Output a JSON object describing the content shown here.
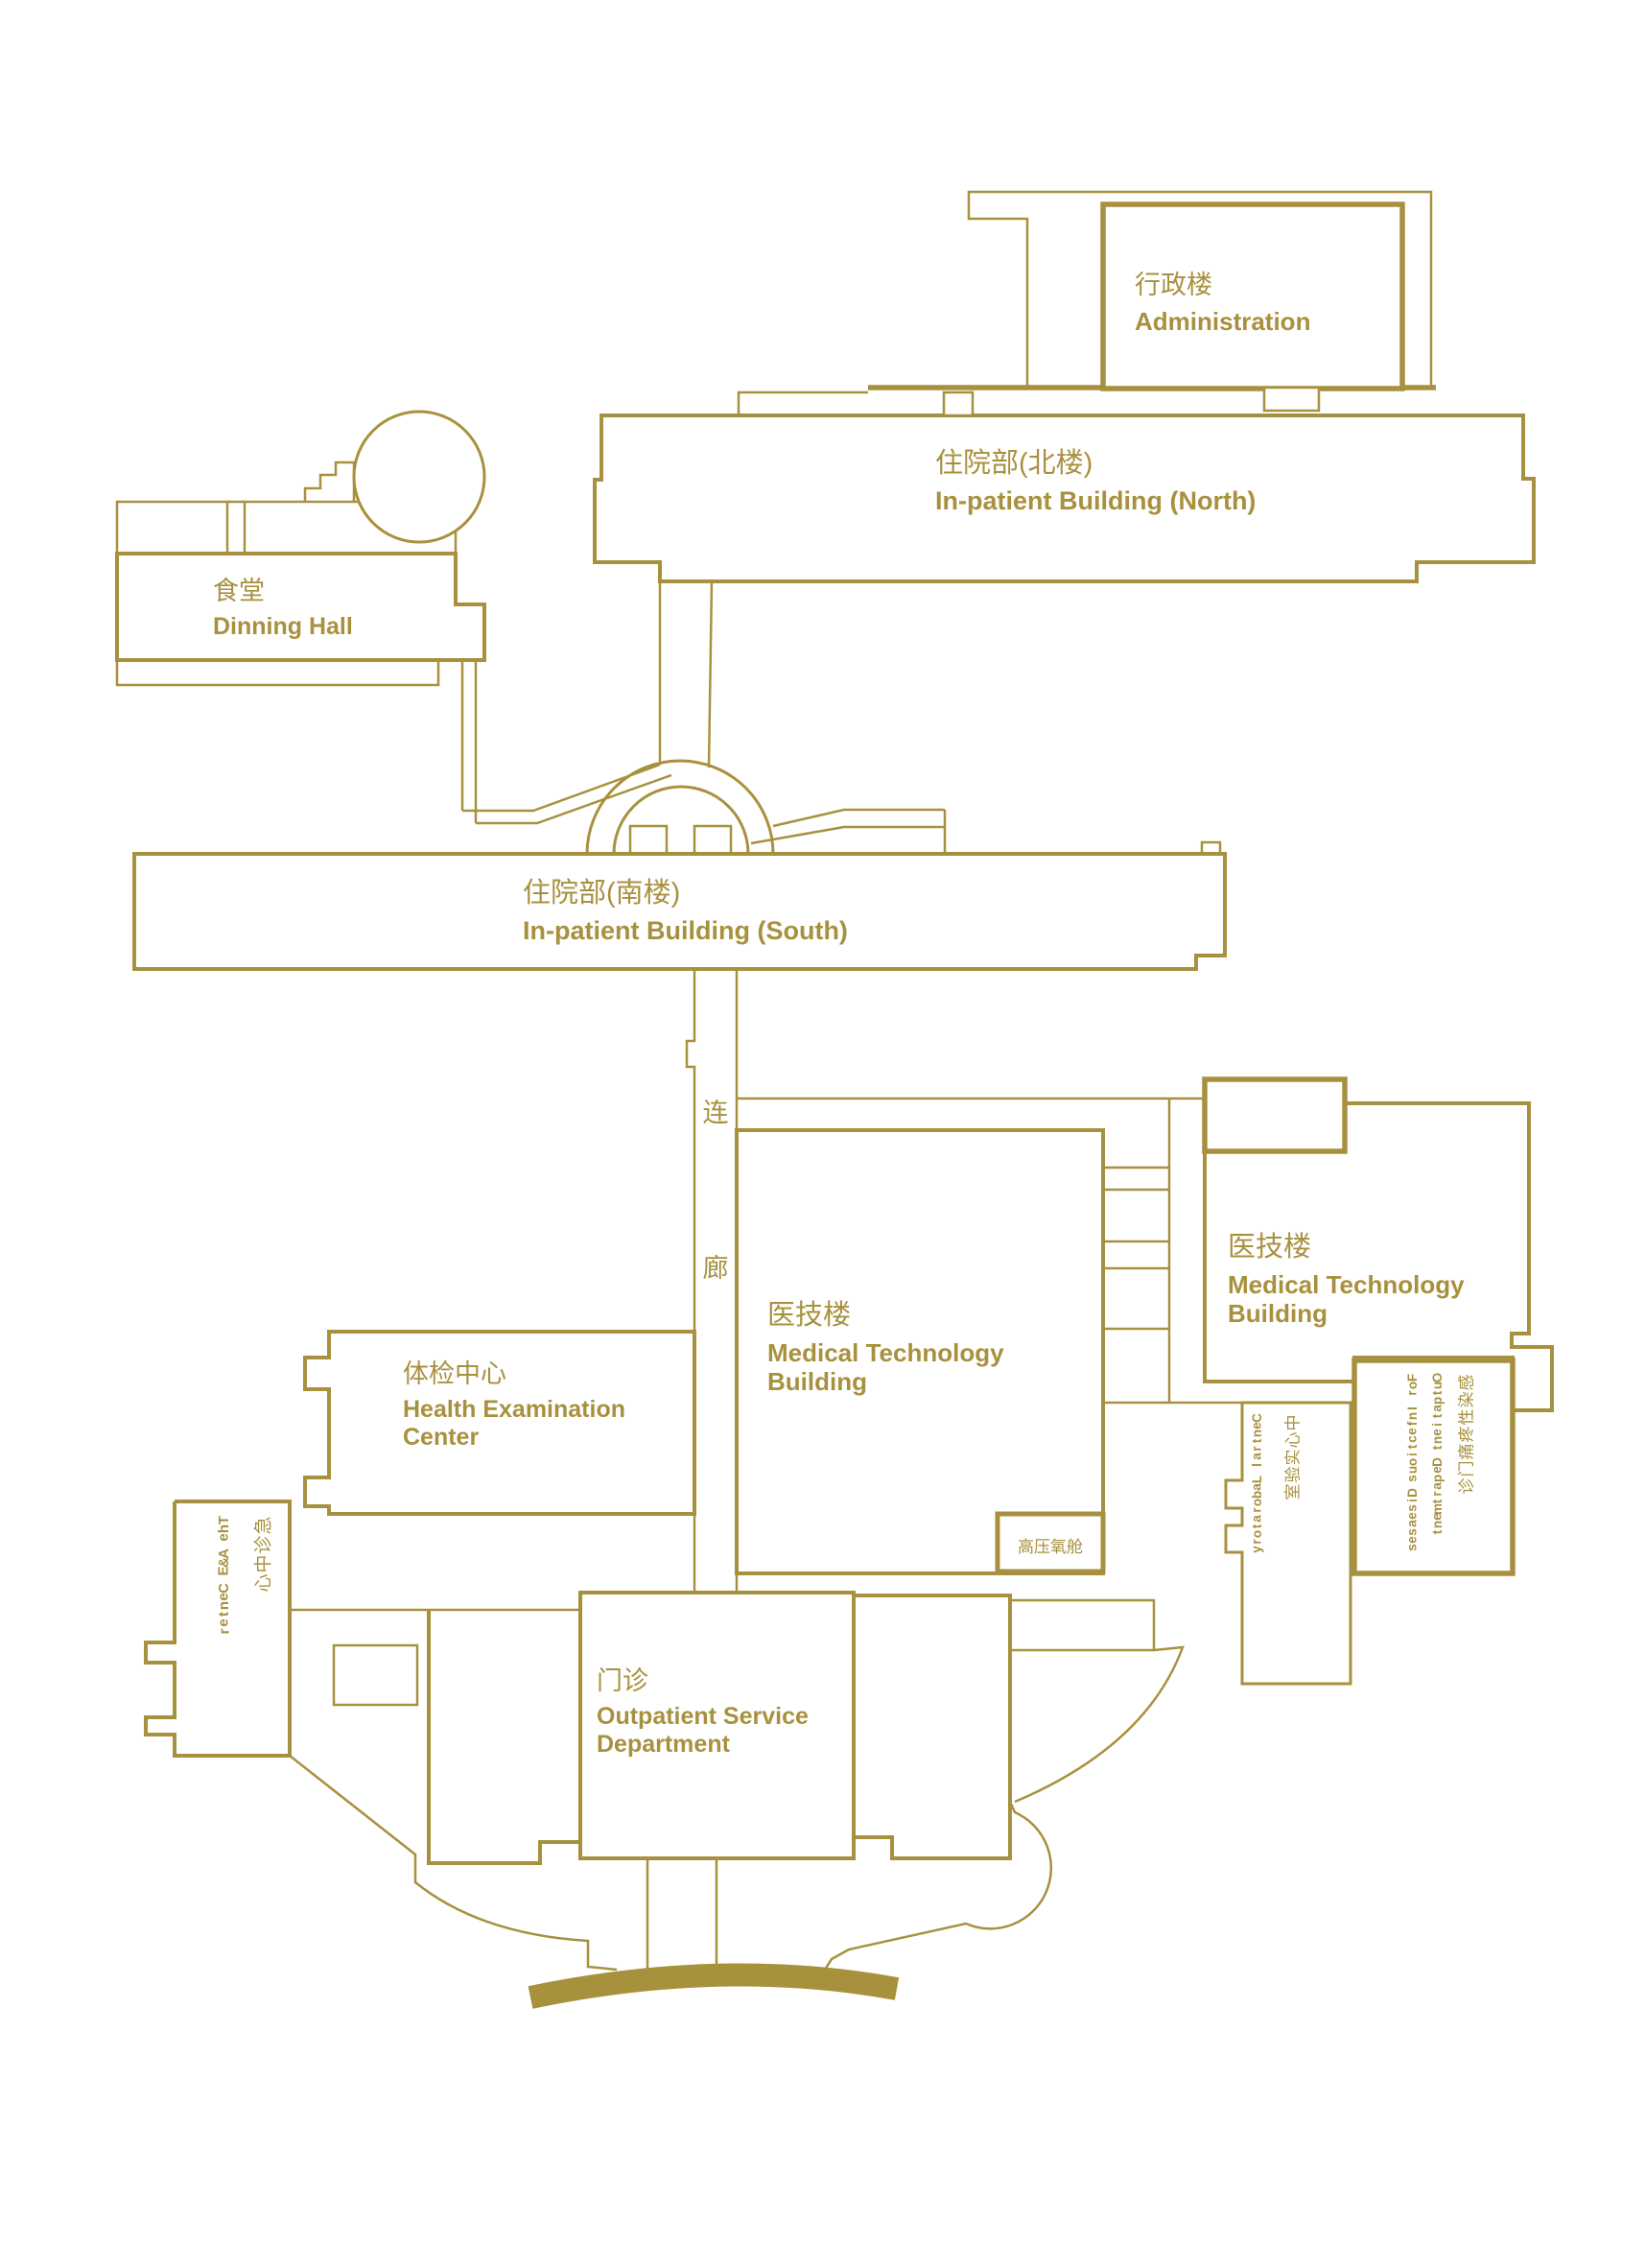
{
  "colors": {
    "gold": "#A8913E",
    "road": "#A8913C",
    "background": "#FFFFFF"
  },
  "buildings": {
    "administration": {
      "zh": "行政楼",
      "en": "Administration"
    },
    "inpatient_north": {
      "zh": "住院部(北楼)",
      "en": "In-patient Building (North)"
    },
    "dinning_hall": {
      "zh": "食堂",
      "en": "Dinning Hall"
    },
    "inpatient_south": {
      "zh": "住院部(南楼)",
      "en": "In-patient Building (South)"
    },
    "corridor": {
      "char1": "连",
      "char2": "廊"
    },
    "medical_tech_central": {
      "zh": "医技楼",
      "en1": "Medical Technology",
      "en2": "Building"
    },
    "medical_tech_east": {
      "zh": "医技楼",
      "en1": "Medical Technology",
      "en2": "Building"
    },
    "health_exam": {
      "zh": "体检中心",
      "en1": "Health Examination",
      "en2": "Center"
    },
    "outpatient": {
      "zh": "门诊",
      "en1": "Outpatient Service",
      "en2": "Department"
    },
    "hyperbaric": {
      "zh": "高压氧舱"
    },
    "ae_center": {
      "lines": [
        "急诊中心",
        "The A&E Center"
      ]
    },
    "central_lab": {
      "lines": [
        "中心实验室",
        "Central Laboratory"
      ]
    },
    "infectious": {
      "lines": [
        "感染性疼痛门诊",
        "Outpatient Department",
        "For Infectious Diseases"
      ]
    }
  }
}
